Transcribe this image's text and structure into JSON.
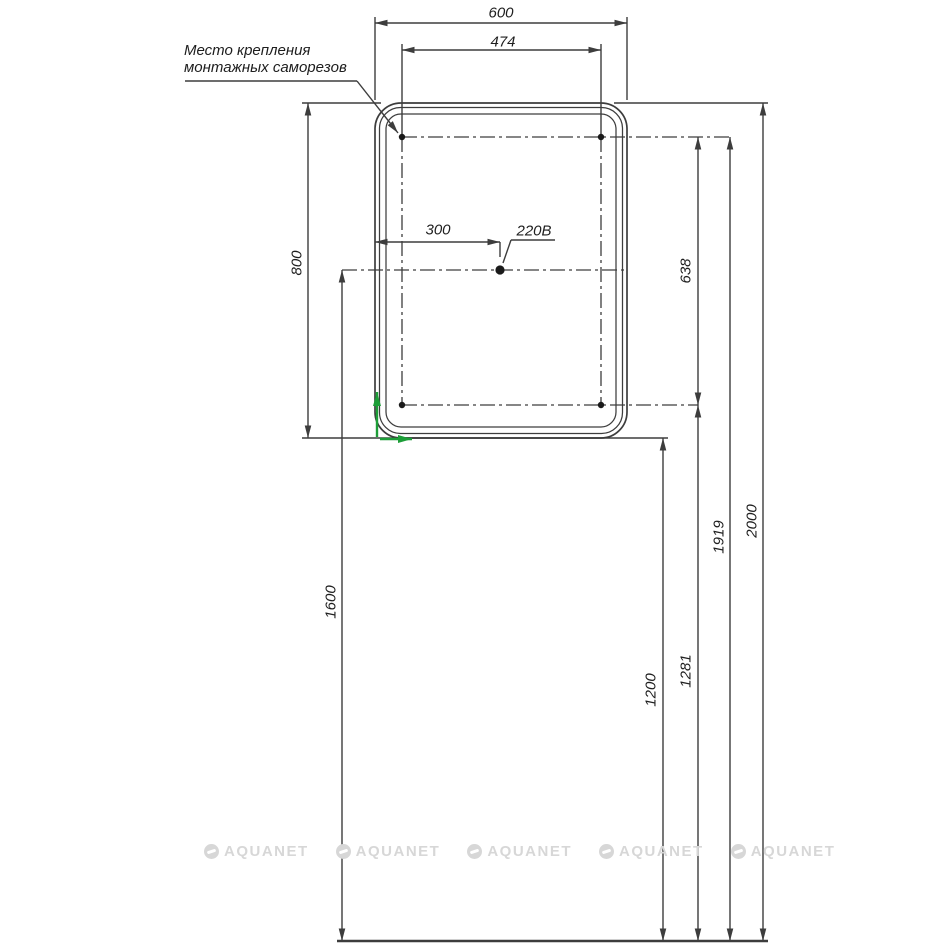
{
  "drawing": {
    "callout": {
      "line1": "Место крепления",
      "line2": "монтажных саморезов"
    },
    "power_label": "220В",
    "dims": {
      "overall_width": "600",
      "screw_spacing_horizontal": "474",
      "socket_offset_x": "300",
      "mirror_height": "800",
      "screw_spacing_vertical": "638",
      "socket_height": "1600",
      "mirror_bottom_height": "1200",
      "bottom_screws_height": "1281",
      "top_screws_height": "1919",
      "mirror_top_height": "2000"
    },
    "watermark": {
      "text": "AQUANET"
    },
    "colors": {
      "line": "#3d3d3d",
      "green": "#1d9e38",
      "watermark": "#d7d7d7",
      "dot": "#1a1a1a"
    }
  }
}
